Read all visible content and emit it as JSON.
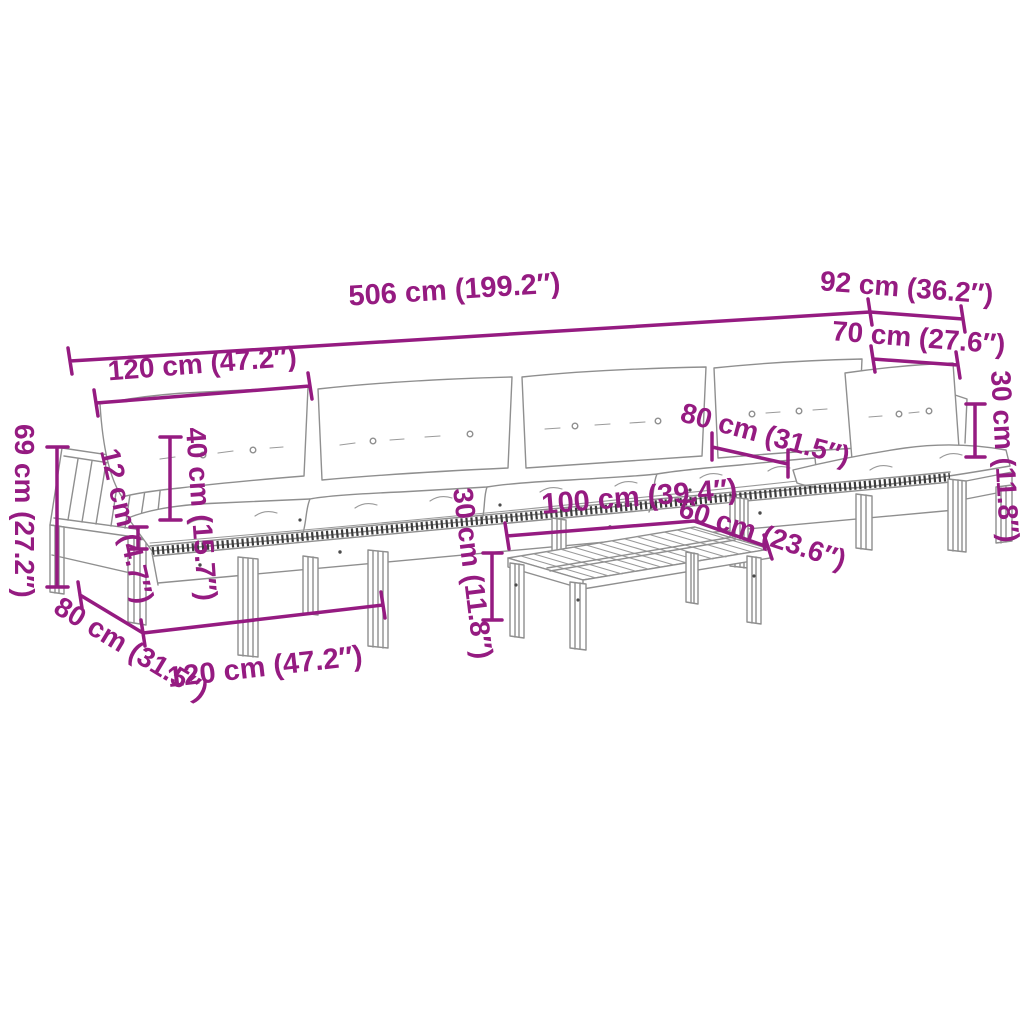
{
  "figure": {
    "description": "Line-art dimension diagram of a pallet-style garden corner sofa set with white cushions and a slatted coffee table"
  },
  "colors": {
    "dimension_accent": "#951b81",
    "line_art": "#8f8f8f",
    "line_art_dark": "#3c3c3c",
    "background": "#ffffff",
    "cushion_fill": "#ffffff"
  },
  "dimensions": {
    "overall_length": {
      "label": "506 cm (199.2″)"
    },
    "corner_depth": {
      "label": "92 cm (36.2″)"
    },
    "corner_seat_width": {
      "label": "70 cm (27.6″)"
    },
    "module_length_top": {
      "label": "120 cm (47.2″)"
    },
    "backrest_height": {
      "label": "40 cm (15.7″)"
    },
    "platform_thickness": {
      "label": "12 cm (4.7″)"
    },
    "overall_height": {
      "label": "69 cm (27.2″)"
    },
    "module_depth_left": {
      "label": "80 cm (31.5″)"
    },
    "module_length_bottom": {
      "label": "120 cm (47.2″)"
    },
    "table_height": {
      "label": "30 cm (11.8″)"
    },
    "table_length": {
      "label": "100 cm (39.4″)"
    },
    "table_width": {
      "label": "60 cm (23.6″)"
    },
    "seat_depth_right": {
      "label": "80 cm (31.5″)"
    },
    "corner_back_height": {
      "label": "30 cm (11.8″)"
    }
  }
}
